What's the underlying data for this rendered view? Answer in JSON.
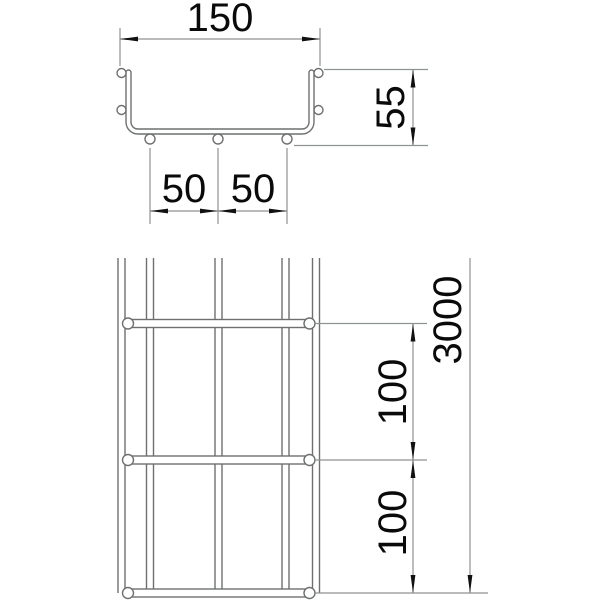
{
  "drawing": {
    "background": "#ffffff",
    "line_color": "#6e7070",
    "dimension_line_color": "#8f9292",
    "text_color": "#0a0a0a",
    "arrow_color": "#111111",
    "cross_section_view": {
      "width_label": "150",
      "height_label": "55",
      "bottom_wire_spacing_labels": [
        "50",
        "50"
      ]
    },
    "plan_view": {
      "length_label": "3000",
      "cross_wire_spacing_labels": [
        "100",
        "100"
      ]
    }
  }
}
